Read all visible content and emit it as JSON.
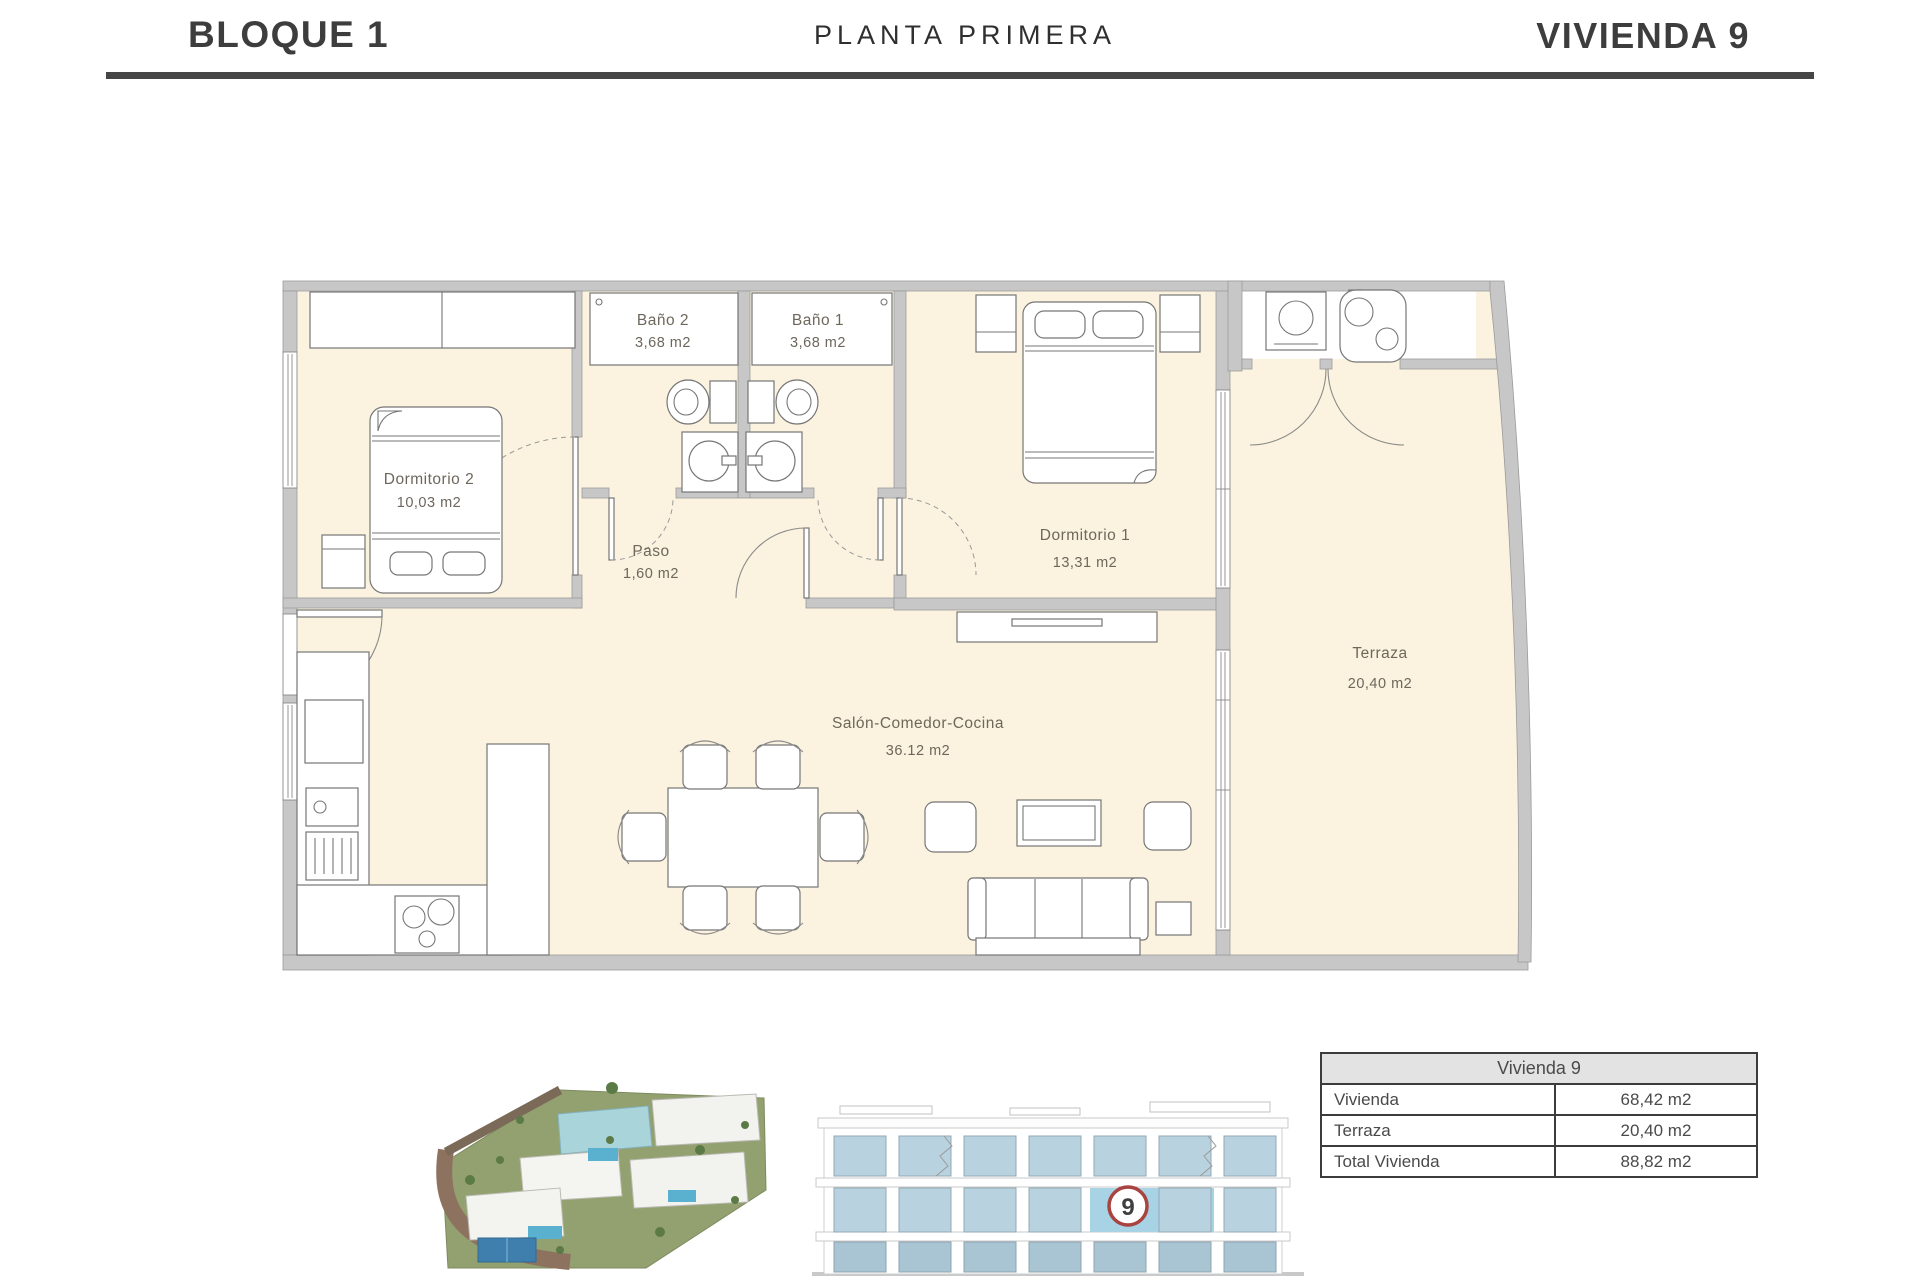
{
  "header": {
    "block": "BLOQUE 1",
    "floor": "PLANTA PRIMERA",
    "unit": "VIVIENDA 9"
  },
  "rooms": [
    {
      "name": "Dormitorio 2",
      "area": "10,03 m2"
    },
    {
      "name": "Baño 2",
      "area": "3,68 m2"
    },
    {
      "name": "Baño 1",
      "area": "3,68 m2"
    },
    {
      "name": "Paso",
      "area": "1,60 m2"
    },
    {
      "name": "Dormitorio 1",
      "area": "13,31 m2"
    },
    {
      "name": "Salón-Comedor-Cocina",
      "area": "36.12 m2"
    },
    {
      "name": "Terraza",
      "area": "20,40 m2"
    }
  ],
  "summary_table": {
    "title": "Vivienda 9",
    "rows": [
      {
        "label": "Vivienda",
        "value": "68,42 m2"
      },
      {
        "label": "Terraza",
        "value": "20,40 m2"
      },
      {
        "label": "Total Vivienda",
        "value": "88,82 m2"
      }
    ]
  },
  "elevation": {
    "badge": "9"
  },
  "colors": {
    "wall": "#c7c7c7",
    "floor": "#fbf3df",
    "accent_red": "#a84340",
    "window_blue": "#b9d2df",
    "header_text": "#3d3d3d"
  }
}
